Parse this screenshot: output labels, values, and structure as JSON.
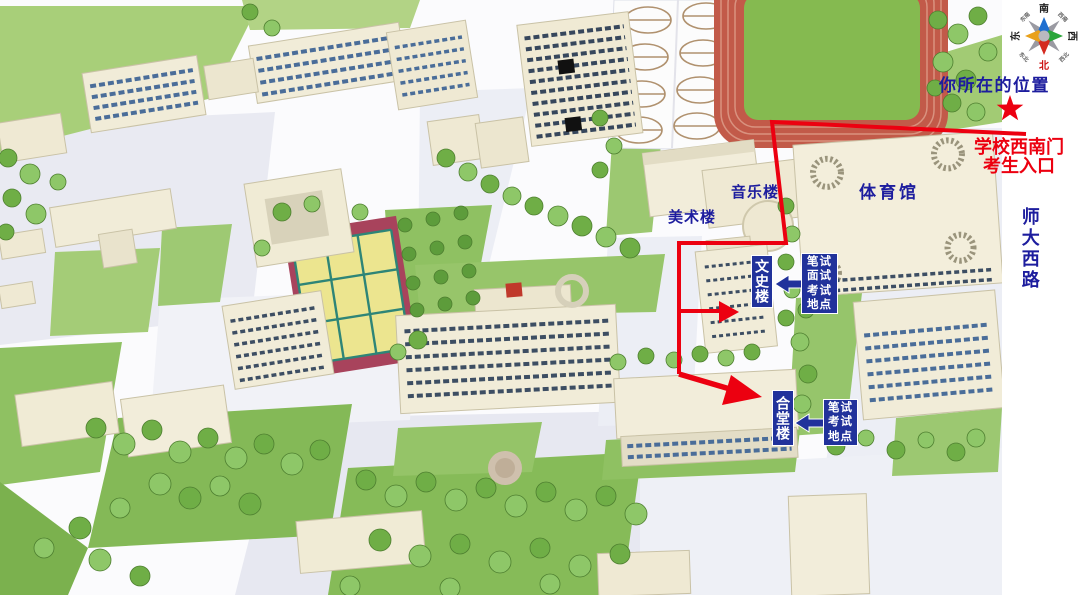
{
  "legend": {
    "your_location": "你所在的位置",
    "gate_line1": "学校西南门",
    "gate_line2": "考生入口",
    "road": "师大西路"
  },
  "buildings": {
    "gymnasium": "体育馆",
    "music": "音乐楼",
    "art": "美术楼",
    "wenshi": "文史楼",
    "hetang": "合堂楼"
  },
  "exam_boxes": {
    "written_interview": {
      "lines": [
        "笔试",
        "面试",
        "考试",
        "地点"
      ]
    },
    "written": {
      "lines": [
        "笔试",
        "考试",
        "地点"
      ]
    }
  },
  "compass": {
    "south": "南",
    "west": "西",
    "east": "东",
    "north": "北",
    "southeast": "东南",
    "southwest": "西南",
    "northeast": "东北",
    "northwest": "西北"
  },
  "colors": {
    "label_blue": "#1d1d9e",
    "route_red": "#ec0010",
    "box_blue": "#21329b",
    "field_green": "#85ba50",
    "track_red": "#c25a49",
    "building_cream": "#f1ecd8"
  }
}
